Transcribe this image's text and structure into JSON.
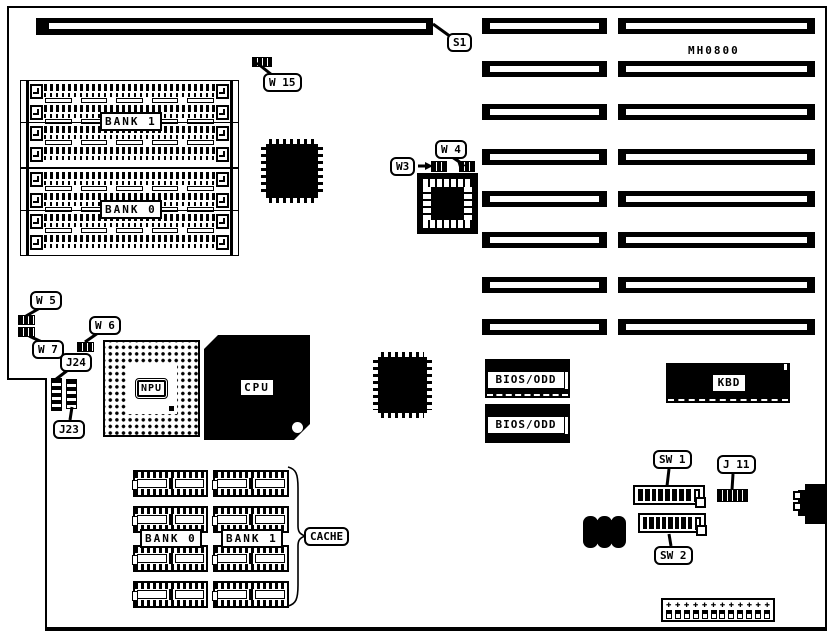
{
  "diagram": {
    "board_model": "MH0800",
    "callouts": {
      "s1": "S1",
      "w15": "W 15",
      "w3": "W3",
      "w4": "W 4",
      "w5": "W 5",
      "w6": "W 6",
      "w7": "W 7",
      "j24": "J24",
      "j23": "J23",
      "sw1": "SW 1",
      "sw2": "SW 2",
      "j11": "J 11",
      "cache": "CACHE"
    },
    "chips": {
      "npu": "NPU",
      "cpu": "CPU",
      "bios_odd_top": "BIOS/ODD",
      "bios_odd_bottom": "BIOS/ODD",
      "kbd": "KBD"
    },
    "memory": {
      "bank1": "BANK 1",
      "bank0": "BANK 0"
    },
    "cache_banks": {
      "bank0": "BANK 0",
      "bank1": "BANK 1"
    },
    "counts": {
      "expansion_slot_rows": 8,
      "expansion_slot_columns": 2,
      "simm_rows_per_bank": 4,
      "cache_dip_rows": 4,
      "cache_dip_columns": 2,
      "dip_switch_on_positions": 8,
      "dip_switch_off_positions": 1,
      "power_pins": 12,
      "spacer_bars_per_gap": 5
    }
  }
}
